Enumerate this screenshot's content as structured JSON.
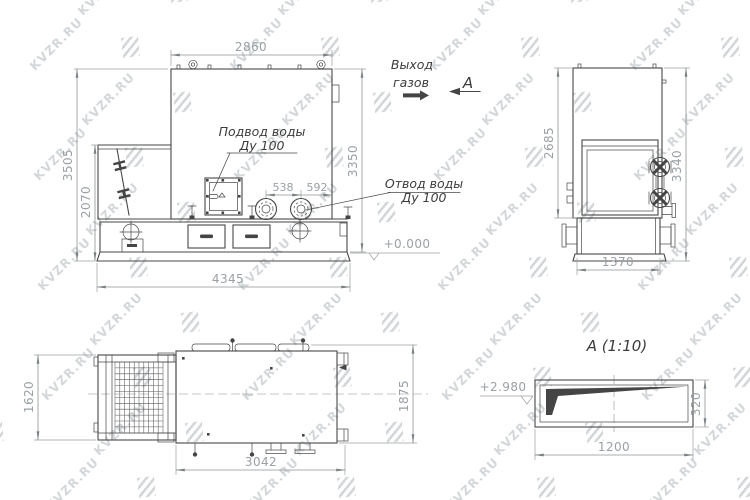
{
  "watermark": {
    "text": "KVZR.RU",
    "color": "#d3d7d9"
  },
  "drawing": {
    "front_view": {
      "dim_width_top": "2860",
      "dim_height_overall": "3505",
      "dim_height_hopper": "2070",
      "dim_height_right": "3350",
      "dim_width_base": "4345",
      "dim_port_spacing": "538",
      "dim_port_to_edge": "592",
      "level_mark": "+0.000",
      "label_water_inlet_line1": "Подвод воды",
      "label_water_inlet_line2": "Ду 100",
      "label_water_outlet_line1": "Отвод воды",
      "label_water_outlet_line2": "Ду 100",
      "label_gas_outlet_line1": "Выход",
      "label_gas_outlet_line2": "газов",
      "section_arrow_letter": "А"
    },
    "side_view": {
      "dim_height_body": "2685",
      "dim_height_overall": "3340",
      "dim_width_base": "1370"
    },
    "plan_view": {
      "dim_width_left": "1620",
      "dim_length_bottom": "3042",
      "dim_width_right": "1875"
    },
    "section_view": {
      "title": "А (1:10)",
      "level_mark": "+2.980",
      "dim_length": "1200",
      "dim_height": "320"
    }
  }
}
